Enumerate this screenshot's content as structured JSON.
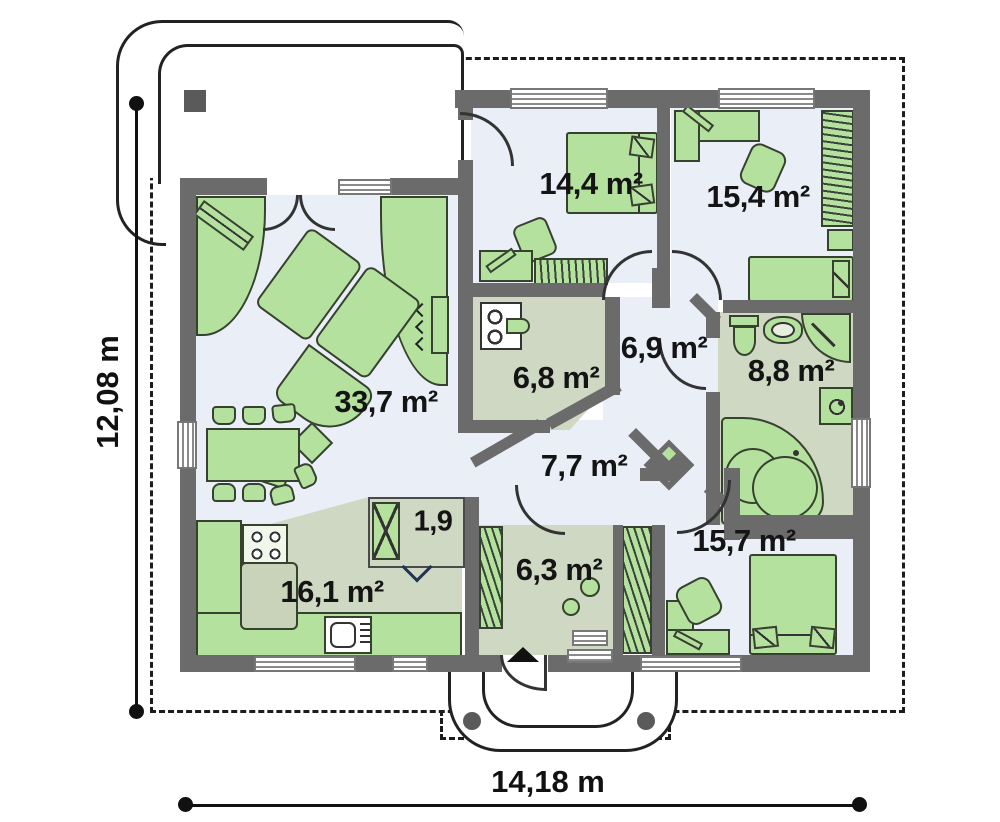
{
  "title": "single-storey house floor plan",
  "dimensions": {
    "width": "14,18 m",
    "height": "12,08 m"
  },
  "rooms": {
    "living": {
      "label": "33,7 m²"
    },
    "bedroom1": {
      "label": "14,4 m²"
    },
    "bedroom2": {
      "label": "15,4 m²"
    },
    "bedroom3": {
      "label": "15,7 m²"
    },
    "kitchen": {
      "label": "16,1 m²"
    },
    "entry": {
      "label": "6,3 m²"
    },
    "hall": {
      "label": "7,7 m²"
    },
    "corridor": {
      "label": "6,9 m²"
    },
    "utility": {
      "label": "6,8 m²"
    },
    "bathroom": {
      "label": "8,8 m²"
    },
    "pantry": {
      "label": "1,9"
    }
  },
  "colors": {
    "wall": "#6b6b6b",
    "floor-cold": "#e9eef7",
    "floor-warm": "#cfd8c2",
    "furn": "#b5e19e",
    "line": "#37412f"
  }
}
